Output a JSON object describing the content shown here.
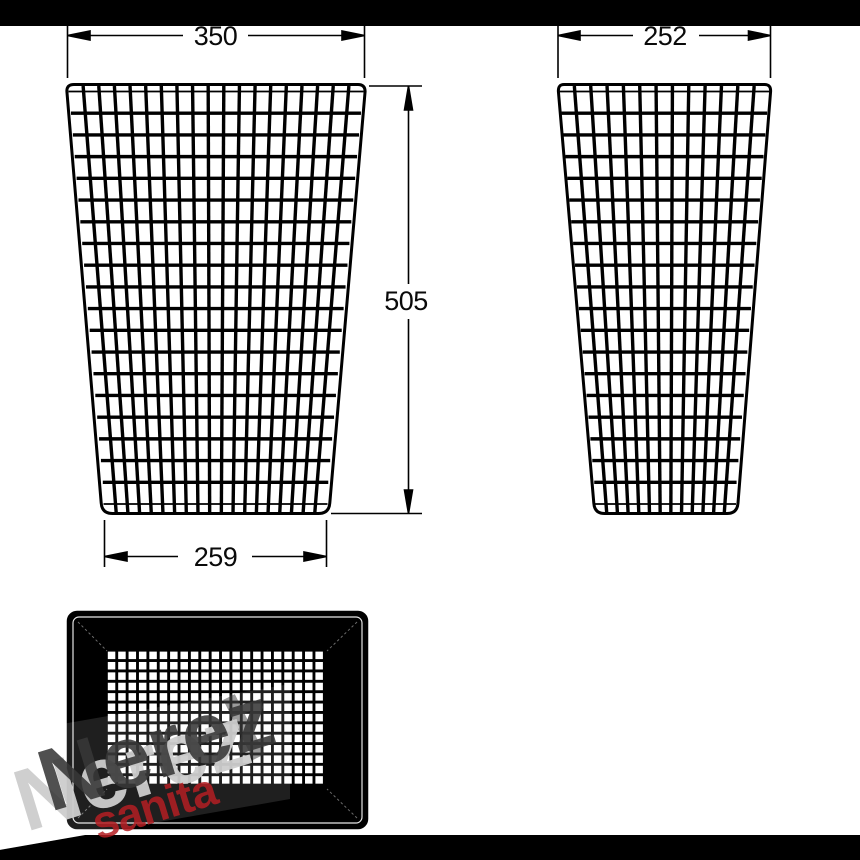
{
  "colors": {
    "background": "#ffffff",
    "letterbox": "#000000",
    "line": "#000000",
    "mesh": "#000000",
    "bottom_view_fill": "#000000",
    "watermark_band": "#ffffff",
    "watermark_brand": "#383838",
    "watermark_brand_shadow": "#cdcdcd",
    "watermark_subbrand": "#b41e23"
  },
  "dimensions": {
    "front_top_width": "350",
    "side_top_width": "252",
    "height": "505",
    "front_bottom_width": "259"
  },
  "watermark": {
    "brand": "Nerez",
    "subbrand": "sanita"
  }
}
